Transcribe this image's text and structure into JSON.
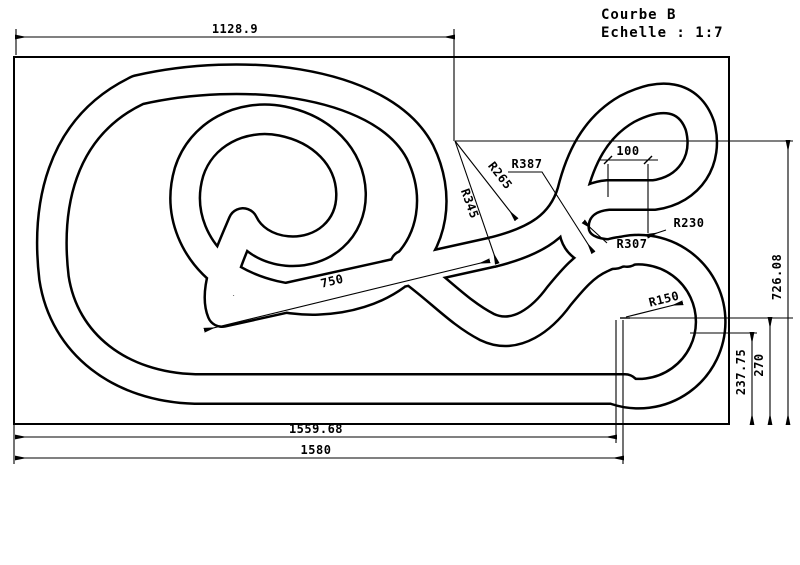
{
  "title_block": {
    "name": "Courbe B",
    "scale": "Echelle :  1:7"
  },
  "dimensions": {
    "top_width": "1128.9",
    "straight_length": "750",
    "lane_gap": "100",
    "bottom_width_inner": "1559.68",
    "bottom_width_outer": "1580",
    "right_height": "726.08",
    "center_height": "270",
    "offset_height": "237.75"
  },
  "radii": {
    "r387": "R387",
    "r345": "R345",
    "r265": "R265",
    "r307": "R307",
    "r230": "R230",
    "r150": "R150"
  },
  "colors": {
    "line": "#000000",
    "background": "#ffffff"
  }
}
